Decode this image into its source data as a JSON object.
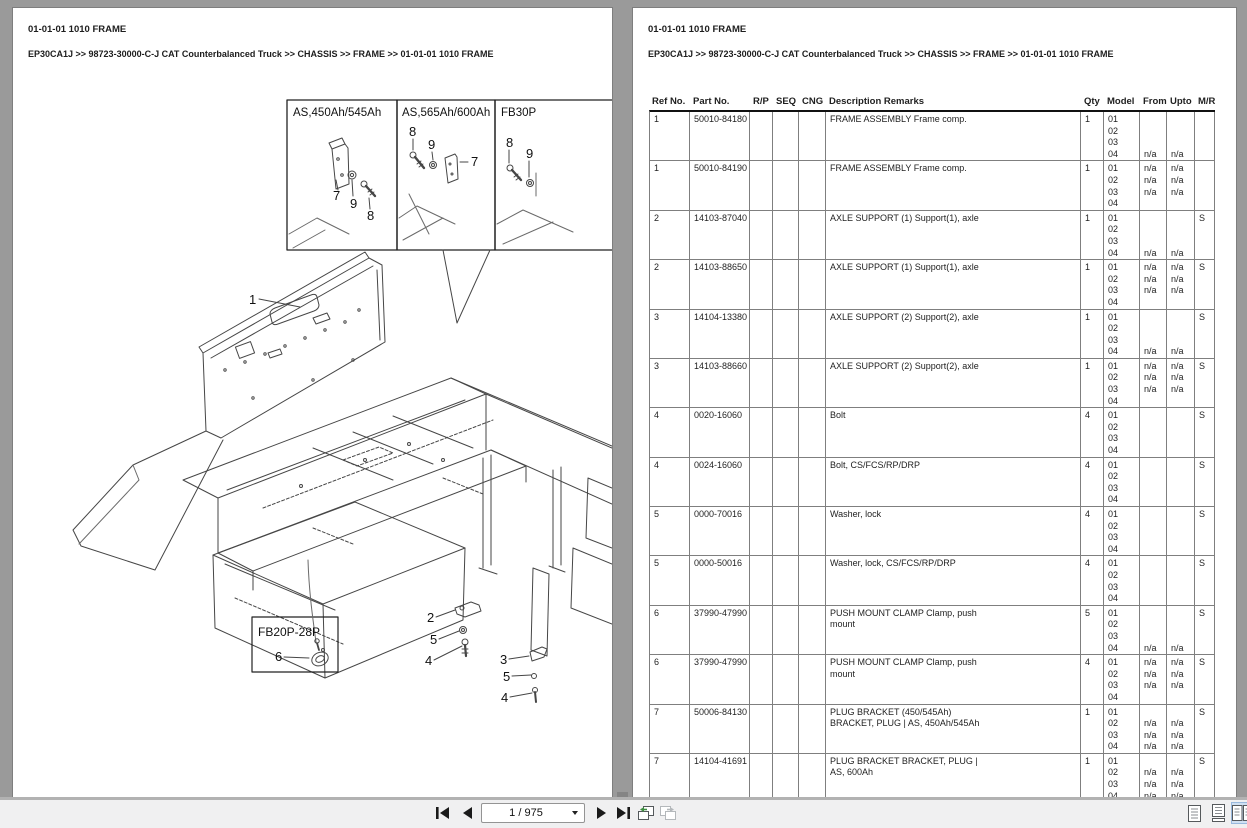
{
  "left_page": {
    "title": "01-01-01 1010 FRAME",
    "breadcrumb": "EP30CA1J >> 98723-30000-C-J CAT Counterbalanced Truck >> CHASSIS >> FRAME >> 01-01-01 1010 FRAME"
  },
  "right_page": {
    "title": "01-01-01 1010 FRAME",
    "breadcrumb": "EP30CA1J >> 98723-30000-C-J CAT Counterbalanced Truck >> CHASSIS >> FRAME >> 01-01-01 1010 FRAME"
  },
  "diagram": {
    "insets": [
      {
        "label": "AS,450Ah/545Ah",
        "callouts": [
          "7",
          "9",
          "8"
        ]
      },
      {
        "label": "AS,565Ah/600Ah",
        "callouts": [
          "8",
          "9",
          "7"
        ]
      },
      {
        "label": "FB30P",
        "callouts": [
          "8",
          "9"
        ]
      }
    ],
    "main_callout": "1",
    "center_callouts": [
      "2",
      "5",
      "4"
    ],
    "right_callouts": [
      "3",
      "5",
      "4"
    ],
    "detail_box": {
      "label": "FB20P-28P",
      "callout": "6"
    }
  },
  "table": {
    "headers": [
      "Ref No.",
      "Part No.",
      "R/P",
      "SEQ",
      "CNG",
      "Description Remarks",
      "Qty",
      "Model",
      "From",
      "Upto",
      "M/R"
    ],
    "rows": [
      {
        "ref": "1",
        "part": "50010-84180",
        "desc": [
          "FRAME ASSEMBLY Frame comp."
        ],
        "qty": "1",
        "model": [
          "01",
          "02",
          "03",
          "04"
        ],
        "from": [
          "",
          "",
          "",
          "n/a"
        ],
        "upto": [
          "",
          "",
          "",
          "n/a"
        ],
        "mr": ""
      },
      {
        "ref": "1",
        "part": "50010-84190",
        "desc": [
          "FRAME ASSEMBLY Frame comp."
        ],
        "qty": "1",
        "model": [
          "01",
          "02",
          "03",
          "04"
        ],
        "from": [
          "n/a",
          "n/a",
          "n/a",
          ""
        ],
        "upto": [
          "n/a",
          "n/a",
          "n/a",
          ""
        ],
        "mr": ""
      },
      {
        "ref": "2",
        "part": "14103-87040",
        "desc": [
          "AXLE SUPPORT (1) Support(1), axle"
        ],
        "qty": "1",
        "model": [
          "01",
          "02",
          "03",
          "04"
        ],
        "from": [
          "",
          "",
          "",
          "n/a"
        ],
        "upto": [
          "",
          "",
          "",
          "n/a"
        ],
        "mr": "S"
      },
      {
        "ref": "2",
        "part": "14103-88650",
        "desc": [
          "AXLE SUPPORT (1) Support(1), axle"
        ],
        "qty": "1",
        "model": [
          "01",
          "02",
          "03",
          "04"
        ],
        "from": [
          "n/a",
          "n/a",
          "n/a",
          ""
        ],
        "upto": [
          "n/a",
          "n/a",
          "n/a",
          ""
        ],
        "mr": "S"
      },
      {
        "ref": "3",
        "part": "14104-13380",
        "desc": [
          "AXLE SUPPORT (2) Support(2), axle"
        ],
        "qty": "1",
        "model": [
          "01",
          "02",
          "03",
          "04"
        ],
        "from": [
          "",
          "",
          "",
          "n/a"
        ],
        "upto": [
          "",
          "",
          "",
          "n/a"
        ],
        "mr": "S"
      },
      {
        "ref": "3",
        "part": "14103-88660",
        "desc": [
          "AXLE SUPPORT (2) Support(2), axle"
        ],
        "qty": "1",
        "model": [
          "01",
          "02",
          "03",
          "04"
        ],
        "from": [
          "n/a",
          "n/a",
          "n/a",
          ""
        ],
        "upto": [
          "n/a",
          "n/a",
          "n/a",
          ""
        ],
        "mr": "S"
      },
      {
        "ref": "4",
        "part": "0020-16060",
        "desc": [
          "Bolt"
        ],
        "qty": "4",
        "model": [
          "01",
          "02",
          "03",
          "04"
        ],
        "from": [
          "",
          "",
          "",
          ""
        ],
        "upto": [
          "",
          "",
          "",
          ""
        ],
        "mr": "S"
      },
      {
        "ref": "4",
        "part": "0024-16060",
        "desc": [
          "Bolt, CS/FCS/RP/DRP"
        ],
        "qty": "4",
        "model": [
          "01",
          "02",
          "03",
          "04"
        ],
        "from": [
          "",
          "",
          "",
          ""
        ],
        "upto": [
          "",
          "",
          "",
          ""
        ],
        "mr": "S"
      },
      {
        "ref": "5",
        "part": "0000-70016",
        "desc": [
          "Washer, lock"
        ],
        "qty": "4",
        "model": [
          "01",
          "02",
          "03",
          "04"
        ],
        "from": [
          "",
          "",
          "",
          ""
        ],
        "upto": [
          "",
          "",
          "",
          ""
        ],
        "mr": "S"
      },
      {
        "ref": "5",
        "part": "0000-50016",
        "desc": [
          "Washer, lock, CS/FCS/RP/DRP"
        ],
        "qty": "4",
        "model": [
          "01",
          "02",
          "03",
          "04"
        ],
        "from": [
          "",
          "",
          "",
          ""
        ],
        "upto": [
          "",
          "",
          "",
          ""
        ],
        "mr": "S"
      },
      {
        "ref": "6",
        "part": "37990-47990",
        "desc": [
          "PUSH MOUNT CLAMP Clamp, push",
          "mount"
        ],
        "qty": "5",
        "model": [
          "01",
          "02",
          "03",
          "04"
        ],
        "from": [
          "",
          "",
          "",
          "n/a"
        ],
        "upto": [
          "",
          "",
          "",
          "n/a"
        ],
        "mr": "S"
      },
      {
        "ref": "6",
        "part": "37990-47990",
        "desc": [
          "PUSH MOUNT CLAMP Clamp, push",
          "mount"
        ],
        "qty": "4",
        "model": [
          "01",
          "02",
          "03",
          "04"
        ],
        "from": [
          "n/a",
          "n/a",
          "n/a",
          ""
        ],
        "upto": [
          "n/a",
          "n/a",
          "n/a",
          ""
        ],
        "mr": "S"
      },
      {
        "ref": "7",
        "part": "50006-84130",
        "desc": [
          "PLUG BRACKET (450/545Ah)",
          "BRACKET, PLUG | AS, 450Ah/545Ah"
        ],
        "qty": "1",
        "model": [
          "01",
          "02",
          "03",
          "04"
        ],
        "from": [
          "",
          "n/a",
          "n/a",
          "n/a"
        ],
        "upto": [
          "",
          "n/a",
          "n/a",
          "n/a"
        ],
        "mr": "S"
      },
      {
        "ref": "7",
        "part": "14104-41691",
        "desc": [
          "PLUG BRACKET BRACKET, PLUG |",
          "AS, 600Ah"
        ],
        "qty": "1",
        "model": [
          "01",
          "02",
          "03",
          "04"
        ],
        "from": [
          "",
          "n/a",
          "n/a",
          "n/a"
        ],
        "upto": [
          "",
          "n/a",
          "n/a",
          "n/a"
        ],
        "mr": "S"
      }
    ]
  },
  "toolbar": {
    "page_indicator": "1 / 975",
    "icons": [
      "first-page",
      "previous-page",
      "next-page",
      "last-page",
      "previous-view",
      "next-view",
      "single-page-view",
      "continuous-view",
      "two-page-view"
    ]
  },
  "colors": {
    "window_frame": "#8e8e8e",
    "toolbar_bg": "#f0f0f1",
    "selected_view_bg": "#cfe0f2",
    "enabled_view_arrow": "#3e8e41",
    "table_border": "#7f7f7f"
  }
}
